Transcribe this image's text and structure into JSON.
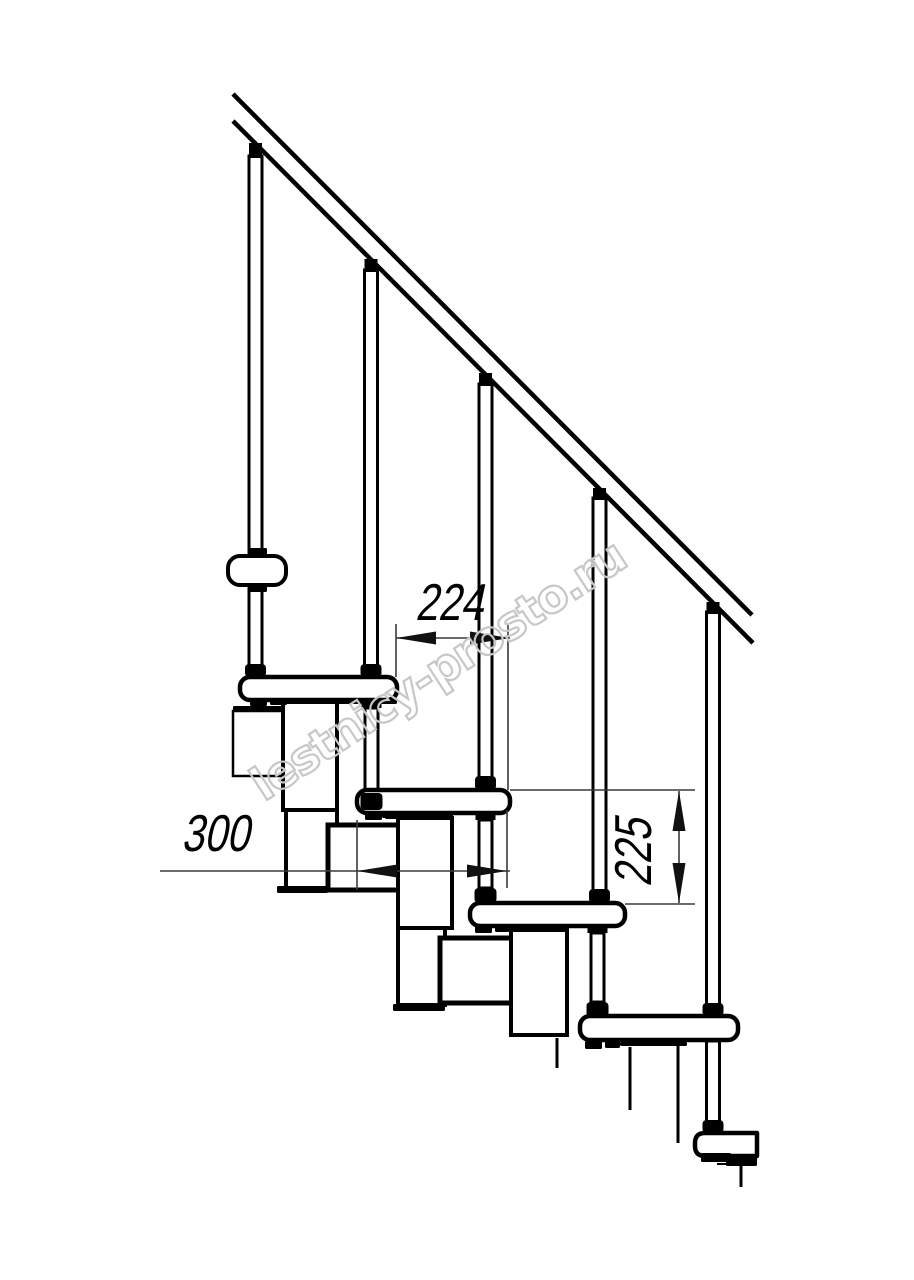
{
  "meta": {
    "title": "Modular staircase side-view technical drawing"
  },
  "canvas": {
    "width": 914,
    "height": 1280,
    "background": "#ffffff",
    "line_color": "#000000",
    "dim_line_color": "#3a3a3a",
    "arrow_color": "#111111",
    "watermark_color": "#c7c7c7"
  },
  "watermark": {
    "text": "lestnicy-prosto.ru",
    "x": 264,
    "y": 802,
    "angle": -33,
    "font_size": 46,
    "letter_spacing": -1.5,
    "stroke_width": 2.2
  },
  "dimensions": [
    {
      "id": "step-run-224",
      "label": "224",
      "orientation": "horizontal",
      "text": {
        "x": 449,
        "y": 620,
        "size": 52,
        "rotate": 0
      },
      "line": [
        396,
        638,
        510,
        638
      ],
      "arrows": [
        {
          "tip": [
            396,
            638
          ],
          "dir": "left"
        },
        {
          "tip": [
            510,
            638
          ],
          "dir": "right"
        }
      ],
      "extensions": [
        [
          396,
          624,
          396,
          677
        ],
        [
          508,
          624,
          508,
          790
        ]
      ]
    },
    {
      "id": "tread-depth-300",
      "label": "300",
      "orientation": "horizontal",
      "text": {
        "x": 215,
        "y": 851,
        "size": 52,
        "rotate": 0
      },
      "line": [
        160,
        871,
        510,
        871
      ],
      "arrows": [
        {
          "tip": [
            357,
            871
          ],
          "dir": "left"
        },
        {
          "tip": [
            507,
            871
          ],
          "dir": "right"
        }
      ],
      "extensions": [
        [
          357,
          820,
          357,
          890
        ],
        [
          507,
          810,
          507,
          888
        ]
      ]
    },
    {
      "id": "step-rise-225",
      "label": "225",
      "orientation": "vertical",
      "text": {
        "x": 651,
        "y": 853,
        "size": 52,
        "rotate": -90
      },
      "line": [
        679,
        791,
        679,
        903
      ],
      "arrows": [
        {
          "tip": [
            679,
            791
          ],
          "dir": "up"
        },
        {
          "tip": [
            679,
            903
          ],
          "dir": "down"
        }
      ],
      "extensions": [
        [
          510,
          790,
          695,
          790
        ],
        [
          625,
          904,
          695,
          904
        ]
      ]
    }
  ],
  "drawing": {
    "rail": {
      "top_line": [
        233,
        94,
        752,
        615
      ],
      "bottom_line": [
        233,
        121,
        753,
        643
      ],
      "stroke": 4.5
    },
    "balusters": [
      {
        "cx": 255.5,
        "connector_y": 143,
        "top": 156,
        "bottom": 677,
        "collar_top": 664
      },
      {
        "cx": 371.0,
        "connector_y": 259,
        "top": 270,
        "bottom": 677,
        "collar_top": 664
      },
      {
        "cx": 485.5,
        "connector_y": 373,
        "top": 384,
        "bottom": 790,
        "collar_top": 776
      },
      {
        "cx": 599.5,
        "connector_y": 488,
        "top": 498,
        "bottom": 903,
        "collar_top": 889
      },
      {
        "cx": 713.0,
        "connector_y": 602,
        "top": 612,
        "bottom": 1016,
        "collar_top": 1003
      }
    ],
    "baluster5_lower": {
      "cx": 713,
      "top": 1041,
      "bottom": 1127,
      "collar_top": 1120
    },
    "supports": [
      {
        "cx": 371.5,
        "pad_y": 700,
        "top": 708,
        "bottom": 793,
        "collar_top": 793,
        "collar_h": 17
      },
      {
        "cx": 485.5,
        "pad_y": 812,
        "top": 820,
        "bottom": 888,
        "collar_top": 888,
        "collar_h": 15
      },
      {
        "cx": 597.5,
        "pad_y": 926,
        "top": 933,
        "bottom": 1002,
        "collar_top": 1002,
        "collar_h": 15
      }
    ],
    "treads": [
      {
        "x": 240,
        "y": 677,
        "w": 157,
        "h": 23,
        "cut_right": false
      },
      {
        "x": 357,
        "y": 790,
        "w": 153,
        "h": 23,
        "cut_right": false
      },
      {
        "x": 470,
        "y": 903,
        "w": 155,
        "h": 23,
        "cut_right": false
      },
      {
        "x": 580,
        "y": 1016,
        "w": 158,
        "h": 24,
        "cut_right": false
      },
      {
        "x": 695,
        "y": 1133,
        "w": 62,
        "h": 23,
        "cut_right": true
      }
    ],
    "tread_stroke": 4.5,
    "modules": [
      {
        "x": 233,
        "y": 711,
        "w": 56,
        "h": 65,
        "sw": 2.5,
        "fill": "none",
        "name": "perp-module-outline"
      },
      {
        "x": 283,
        "y": 700,
        "w": 54,
        "h": 110,
        "sw": 4,
        "fill": "#ffffff",
        "name": "module-box"
      },
      {
        "x": 286,
        "y": 810,
        "w": 51,
        "h": 78,
        "sw": 4,
        "fill": "#ffffff",
        "name": "module-box"
      },
      {
        "x": 328,
        "y": 825,
        "w": 75,
        "h": 65,
        "sw": 5,
        "fill": "#ffffff",
        "name": "module-box-square"
      },
      {
        "x": 398,
        "y": 818,
        "w": 54,
        "h": 110,
        "sw": 4,
        "fill": "#ffffff",
        "name": "module-box"
      },
      {
        "x": 398,
        "y": 928,
        "w": 47,
        "h": 77,
        "sw": 4,
        "fill": "#ffffff",
        "name": "module-box"
      },
      {
        "x": 440,
        "y": 938,
        "w": 76,
        "h": 65,
        "sw": 5,
        "fill": "#ffffff",
        "name": "module-box-square"
      },
      {
        "x": 511,
        "y": 930,
        "w": 56,
        "h": 105,
        "sw": 4,
        "fill": "#ffffff",
        "name": "module-box"
      }
    ],
    "black_shapes": [
      {
        "x": 250,
        "y": 698,
        "w": 17,
        "h": 8
      },
      {
        "x": 270,
        "y": 698,
        "w": 17,
        "h": 7
      },
      {
        "x": 285,
        "y": 698,
        "w": 112,
        "h": 6
      },
      {
        "x": 233,
        "y": 706,
        "w": 50,
        "h": 6
      },
      {
        "x": 277,
        "y": 886,
        "w": 51,
        "h": 7
      },
      {
        "x": 365,
        "y": 813,
        "w": 17,
        "h": 7
      },
      {
        "x": 385,
        "y": 813,
        "w": 18,
        "h": 6
      },
      {
        "x": 382,
        "y": 813,
        "w": 71,
        "h": 5
      },
      {
        "x": 393,
        "y": 1004,
        "w": 52,
        "h": 7
      },
      {
        "x": 475,
        "y": 925,
        "w": 17,
        "h": 8
      },
      {
        "x": 495,
        "y": 925,
        "w": 13,
        "h": 7
      },
      {
        "x": 507,
        "y": 926,
        "w": 60,
        "h": 6
      },
      {
        "x": 585,
        "y": 1041,
        "w": 17,
        "h": 8
      },
      {
        "x": 605,
        "y": 1041,
        "w": 15,
        "h": 7
      },
      {
        "x": 620,
        "y": 1042,
        "w": 67,
        "h": 4
      },
      {
        "x": 701,
        "y": 1153,
        "w": 30,
        "h": 9
      },
      {
        "x": 726,
        "y": 1157,
        "w": 31,
        "h": 9
      },
      {
        "x": 249,
        "y": 548,
        "w": 18,
        "h": 9
      },
      {
        "x": 249,
        "y": 584,
        "w": 18,
        "h": 8
      }
    ],
    "plain_lines": [
      [
        557,
        1038,
        557,
        1068,
        3
      ],
      [
        630,
        1047,
        630,
        1110,
        3
      ],
      [
        678,
        1042,
        678,
        1143,
        3
      ],
      [
        741,
        1166,
        741,
        1187,
        3
      ],
      [
        717,
        1164,
        755,
        1164,
        2
      ]
    ],
    "post_clamp_bar": {
      "x": 228,
      "y": 556,
      "w": 58,
      "h": 29,
      "r": 12,
      "sw": 4
    },
    "baluster_width": 13,
    "baluster_stroke": 3
  }
}
